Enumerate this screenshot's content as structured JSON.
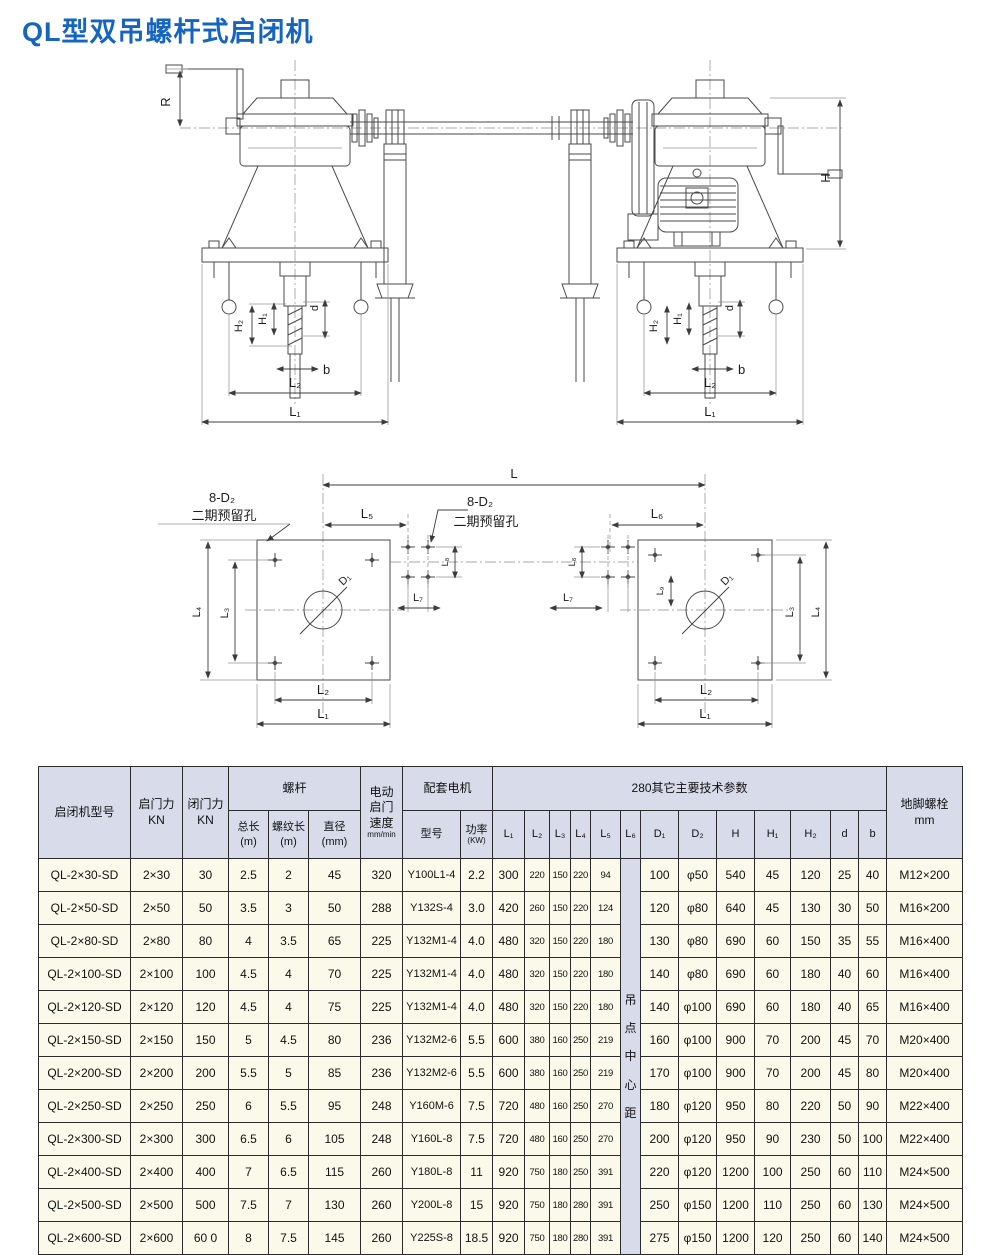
{
  "page": {
    "title": "QL型双吊螺杆式启闭机"
  },
  "colors": {
    "title": "#1565c0",
    "header_bg": "#d8dcea",
    "cell_bg": "#faf9ea",
    "border": "#2b2b2b",
    "line": "#4a4a4a"
  },
  "drawings": {
    "front": {
      "labels": {
        "r": "R",
        "h": "H",
        "h1": "H₁",
        "h2": "H₂",
        "d": "d",
        "b": "b",
        "l1": "L₁",
        "l2": "L₂"
      }
    },
    "plan": {
      "labels": {
        "l": "L",
        "l1": "L₁",
        "l2": "L₂",
        "l3": "L₃",
        "l4": "L₄",
        "l5": "L₅",
        "l6": "L₆",
        "l7": "L₇",
        "l8": "L₈",
        "l9": "L₉",
        "d1": "D₁",
        "holes": "8-D₂",
        "holes_note": "二期预留孔"
      }
    }
  },
  "table": {
    "group_headers": {
      "model": "启闭机型号",
      "open_force": "启门力\nKN",
      "close_force": "闭门力\nKN",
      "screw": "螺杆",
      "speed_title": "电动\n启门\n速度",
      "speed_unit": "mm/min",
      "motor": "配套电机",
      "tech_params": "280其它主要技术参数",
      "anchor_bolt": "地脚螺栓\nmm"
    },
    "sub_headers": {
      "total_len": "总长\n(m)",
      "thread_len": "螺纹长\n(m)",
      "diameter": "直径\n(mm)",
      "motor_model": "型号",
      "power_title": "功率",
      "power_unit": "(KW)",
      "dims": [
        "L₁",
        "L₂",
        "L₃",
        "L₄",
        "L₅",
        "L₆",
        "D₁",
        "D₂",
        "H",
        "H₁",
        "H₂",
        "d",
        "b"
      ]
    },
    "merged_cell": {
      "text": "吊点中心距",
      "col_index": 14
    },
    "rows": [
      [
        "QL-2×30-SD",
        "2×30",
        "30",
        "2.5",
        "2",
        "45",
        "320",
        "Y100L1-4",
        "2.2",
        "300",
        "220",
        "150",
        "220",
        "94",
        "100",
        "φ50",
        "540",
        "45",
        "120",
        "25",
        "40",
        "M12×200"
      ],
      [
        "QL-2×50-SD",
        "2×50",
        "50",
        "3.5",
        "3",
        "50",
        "288",
        "Y132S-4",
        "3.0",
        "420",
        "260",
        "150",
        "220",
        "124",
        "120",
        "φ80",
        "640",
        "45",
        "130",
        "30",
        "50",
        "M16×200"
      ],
      [
        "QL-2×80-SD",
        "2×80",
        "80",
        "4",
        "3.5",
        "65",
        "225",
        "Y132M1-4",
        "4.0",
        "480",
        "320",
        "150",
        "220",
        "180",
        "130",
        "φ80",
        "690",
        "60",
        "150",
        "35",
        "55",
        "M16×400"
      ],
      [
        "QL-2×100-SD",
        "2×100",
        "100",
        "4.5",
        "4",
        "70",
        "225",
        "Y132M1-4",
        "4.0",
        "480",
        "320",
        "150",
        "220",
        "180",
        "140",
        "φ80",
        "690",
        "60",
        "180",
        "40",
        "60",
        "M16×400"
      ],
      [
        "QL-2×120-SD",
        "2×120",
        "120",
        "4.5",
        "4",
        "75",
        "225",
        "Y132M1-4",
        "4.0",
        "480",
        "320",
        "150",
        "220",
        "180",
        "140",
        "φ100",
        "690",
        "60",
        "180",
        "40",
        "65",
        "M16×400"
      ],
      [
        "QL-2×150-SD",
        "2×150",
        "150",
        "5",
        "4.5",
        "80",
        "236",
        "Y132M2-6",
        "5.5",
        "600",
        "380",
        "160",
        "250",
        "219",
        "160",
        "φ100",
        "900",
        "70",
        "200",
        "45",
        "70",
        "M20×400"
      ],
      [
        "QL-2×200-SD",
        "2×200",
        "200",
        "5.5",
        "5",
        "85",
        "236",
        "Y132M2-6",
        "5.5",
        "600",
        "380",
        "160",
        "250",
        "219",
        "170",
        "φ100",
        "900",
        "70",
        "200",
        "45",
        "80",
        "M20×400"
      ],
      [
        "QL-2×250-SD",
        "2×250",
        "250",
        "6",
        "5.5",
        "95",
        "248",
        "Y160M-6",
        "7.5",
        "720",
        "480",
        "160",
        "250",
        "270",
        "180",
        "φ120",
        "950",
        "80",
        "220",
        "50",
        "90",
        "M22×400"
      ],
      [
        "QL-2×300-SD",
        "2×300",
        "300",
        "6.5",
        "6",
        "105",
        "248",
        "Y160L-8",
        "7.5",
        "720",
        "480",
        "160",
        "250",
        "270",
        "200",
        "φ120",
        "950",
        "90",
        "230",
        "50",
        "100",
        "M22×400"
      ],
      [
        "QL-2×400-SD",
        "2×400",
        "400",
        "7",
        "6.5",
        "115",
        "260",
        "Y180L-8",
        "11",
        "920",
        "750",
        "180",
        "250",
        "391",
        "220",
        "φ120",
        "1200",
        "100",
        "250",
        "60",
        "110",
        "M24×500"
      ],
      [
        "QL-2×500-SD",
        "2×500",
        "500",
        "7.5",
        "7",
        "130",
        "260",
        "Y200L-8",
        "15",
        "920",
        "750",
        "180",
        "280",
        "391",
        "250",
        "φ150",
        "1200",
        "110",
        "250",
        "60",
        "130",
        "M24×500"
      ],
      [
        "QL-2×600-SD",
        "2×600",
        "60 0",
        "8",
        "7.5",
        "145",
        "260",
        "Y225S-8",
        "18.5",
        "920",
        "750",
        "180",
        "280",
        "391",
        "275",
        "φ150",
        "1200",
        "120",
        "250",
        "60",
        "140",
        "M24×500"
      ]
    ]
  }
}
